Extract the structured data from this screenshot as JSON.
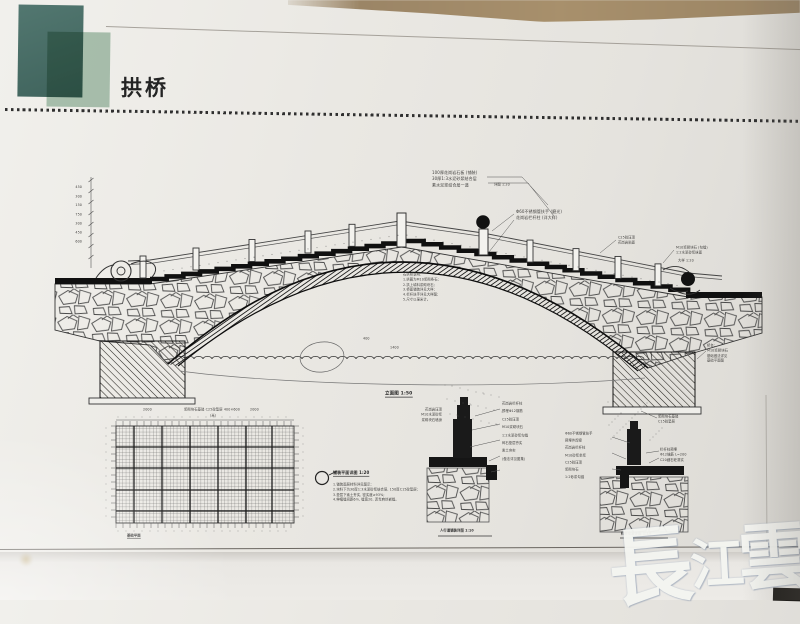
{
  "page": {
    "title": "拱桥"
  },
  "watermark": {
    "text": "長江雲",
    "chars": [
      "長",
      "江",
      "雲"
    ],
    "color": "#f4f5f1"
  },
  "logo": {
    "dark_color": "#46695f",
    "light_color": "#a6c4b1"
  },
  "drawing": {
    "labels": {
      "elevation": "立面图 1:50",
      "grid_plan": "基础平面",
      "grid_unit": "(米)",
      "callout_title": "铺装平面详图 1:20",
      "walkway_detail": "人行道铺装详图 1:10",
      "railing_detail": "栏杆安装详图 1:10",
      "detail_ref": "详图 1:20",
      "detail_ref2": "大样 1:20"
    },
    "dims": {
      "grid_left": "2000",
      "grid_mid": "浆砌块石基础 C25砼垫层 400×600",
      "grid_right": "2000",
      "crown_a": "400",
      "crown_b": "1400",
      "left_stack": [
        "450",
        "300",
        "150",
        "750",
        "300",
        "450",
        "600"
      ]
    },
    "annotations": {
      "top_paving": [
        "100厚花岗岩石板 (铺装)",
        "30厚1:3水泥砂浆结合层",
        "素水泥浆结合层一道"
      ],
      "right_upper": [
        "Φ60不锈钢管扶手 (磨光)",
        "花岗岩栏杆柱 (详大样)"
      ],
      "right_mid_a": [
        "C25砼压顶",
        "花岗岩贴面"
      ],
      "right_mid_b": [
        "M10浆砌块石 (勾缝)",
        "1:2水泥砂浆抹面"
      ],
      "under_arch": [
        "石拱桥说明：",
        "1.拱圈为M10浆砌条石;",
        "2.拱上填料浆砌块石;",
        "3.桥面铺装详见大样;",
        "4.栏杆扶手详见大样图;",
        "5.尺寸以毫米计。"
      ],
      "abutment_note": [
        "桥台:",
        "M10浆砌块石",
        "基础做法详见",
        "基础平面图"
      ],
      "footing_note": [
        "浆砌块石基础",
        "C15砼垫层"
      ],
      "callout_notes": [
        "1.铺装面层材料详见图示;",
        "2.块料下为30厚1:3水泥砂浆结合层, 150厚C15砼垫层;",
        "3.垫层下素土夯实, 密实度≥93%;",
        "4.伸缩缝间距6m, 缝宽20, 沥青麻丝嵌缝。"
      ],
      "mid_left": [
        "花岗岩压顶",
        "M10水泥砂浆",
        "浆砌块石墙身"
      ],
      "mid_right": [
        "花岗岩栏杆柱",
        "预埋Φ12钢筋",
        "C25砼压顶",
        "M10浆砌块石",
        "1:2水泥砂浆勾缝",
        "碎石垫层夯实",
        "素土夯实",
        "(做法详见图集)"
      ],
      "rd_left": [
        "Φ60不锈钢管扶手",
        "预埋件焊接",
        "花岗岩栏杆柱",
        "M10砂浆坐浆",
        "C25砼压顶",
        "浆砌块石",
        "1:2砂浆勾缝"
      ],
      "rd_right": [
        "栏杆柱预埋",
        "Φ12锚筋 L=200",
        "C20细石砼灌实"
      ]
    }
  }
}
